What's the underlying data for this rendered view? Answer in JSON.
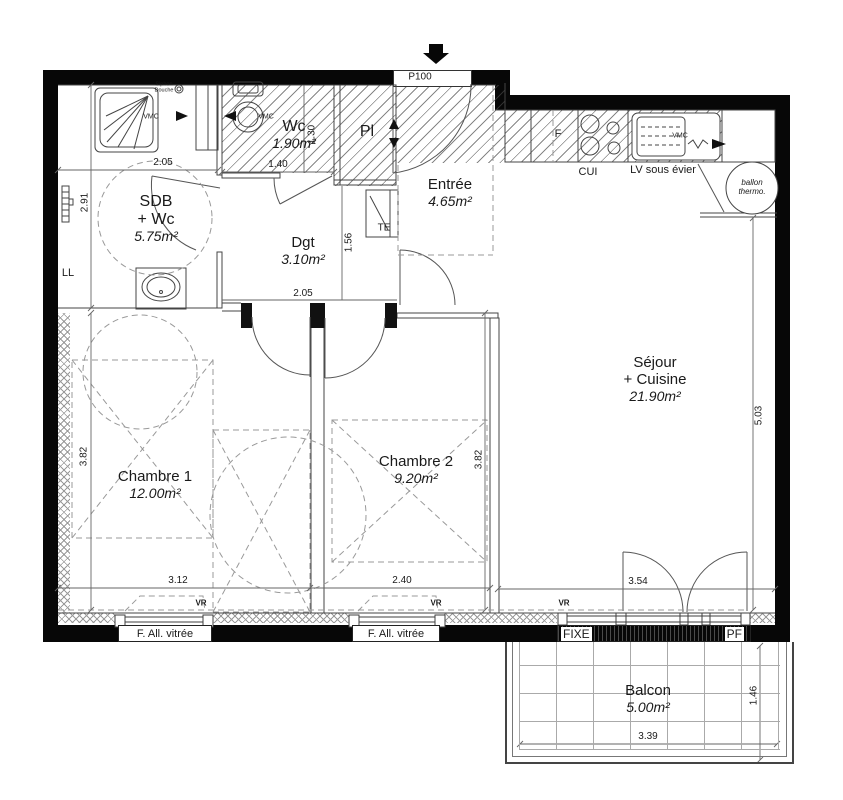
{
  "colors": {
    "wall": "#070707",
    "line": "#444444",
    "dash": "#999999",
    "text": "#1a1a1a"
  },
  "rooms": {
    "sdb": {
      "name": "SDB\n+ Wc",
      "area": "5.75m²"
    },
    "wc": {
      "name": "Wc",
      "area": "1.90m²"
    },
    "pl": {
      "name": "Pl",
      "area": ""
    },
    "entree": {
      "name": "Entrée",
      "area": "4.65m²"
    },
    "dgt": {
      "name": "Dgt",
      "area": "3.10m²"
    },
    "sejour": {
      "name": "Séjour\n+ Cuisine",
      "area": "21.90m²"
    },
    "chambre1": {
      "name": "Chambre 1",
      "area": "12.00m²"
    },
    "chambre2": {
      "name": "Chambre 2",
      "area": "9.20m²"
    },
    "balcon": {
      "name": "Balcon",
      "area": "5.00m²"
    }
  },
  "dimensions": {
    "sdb_width": "2.05",
    "sdb_height": "2.91",
    "wc_width": "1.40",
    "wc_height": "1.30",
    "dgt_width": "2.05",
    "dgt_height": "1.56",
    "c1_width": "3.12",
    "c1_height": "3.82",
    "c2_width": "2.40",
    "c2_height": "3.82",
    "sejour_height": "5.03",
    "sejour_bay": "3.54",
    "balcon_width": "3.39",
    "balcon_height": "1.46"
  },
  "labels": {
    "door_code": "P100",
    "vmc": "VMC",
    "siphon": "Siphon\nDouche",
    "washing_machine": "LL",
    "electrical": "TE",
    "fridge": "F",
    "kitchen": "CUI",
    "dishwasher": "LV sous évier",
    "water_heater": "ballon\nthermo.",
    "shutter": "VR",
    "window_glazed": "F. All. vitrée",
    "fixed_pane": "FIXE",
    "french_door": "PF"
  }
}
